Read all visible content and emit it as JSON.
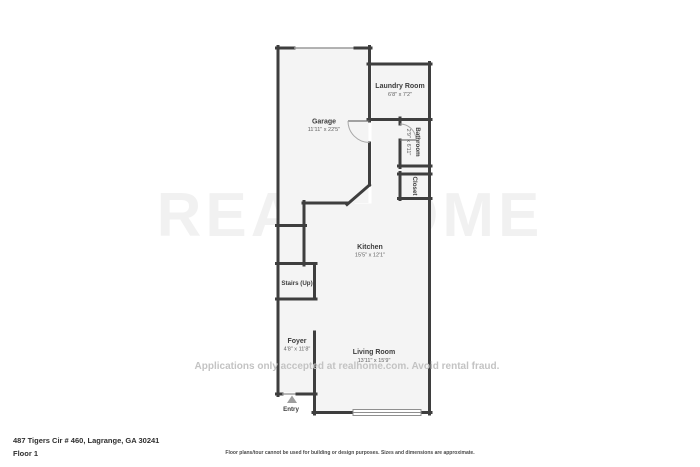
{
  "page": {
    "address": "487 Tigers Cir # 460, Lagrange, GA 30241",
    "floor": "Floor 1",
    "disclaimer": "Floor plans/tour cannot be used for building or design purposes. Sizes and dimensions are approximate.",
    "watermark": {
      "logo": "REALHOME",
      "line": "Applications only accepted at realhome.com. Avoid rental fraud."
    },
    "rooms": {
      "garage": {
        "name": "Garage",
        "dims": "11'11\" x 22'5\""
      },
      "laundry": {
        "name": "Laundry Room",
        "dims": "6'8\" x 7'2\""
      },
      "bathroom": {
        "name": "Bathroom",
        "dims": "2'9\" x 6'11\""
      },
      "closet": {
        "name": "Closet"
      },
      "kitchen": {
        "name": "Kitchen",
        "dims": "15'5\" x 12'1\""
      },
      "stairs": {
        "name": "Stairs (Up)"
      },
      "foyer": {
        "name": "Foyer",
        "dims": "4'8\" x 11'8\""
      },
      "living": {
        "name": "Living Room",
        "dims": "13'11\" x 15'9\""
      },
      "entry": {
        "name": "Entry"
      }
    },
    "colors": {
      "wall": "#3e3e3e",
      "room_fill": "#f4f4f4",
      "label_text": "#3d3d3d",
      "watermark_text": "#c3c3c3"
    }
  }
}
